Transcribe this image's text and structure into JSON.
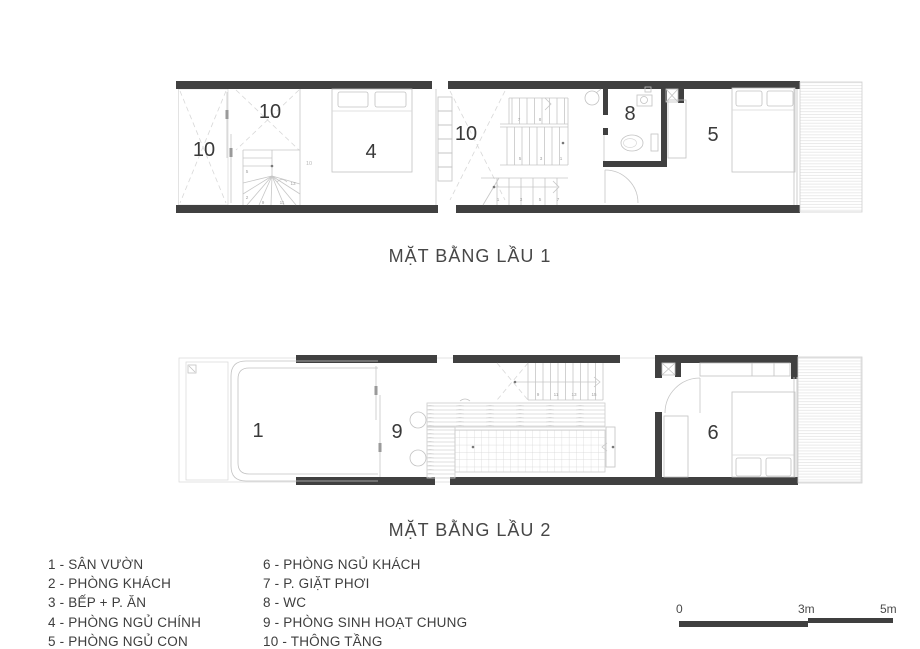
{
  "plan1": {
    "title": "MẶT BẰNG LẦU 1",
    "labels": {
      "void_left": "10",
      "void_mid": "10",
      "bed_main": "4",
      "void_stair": "10",
      "wc": "8",
      "bed_child": "5"
    },
    "stair": {
      "upper": [
        "7",
        "8"
      ],
      "mid": [
        "5",
        "3",
        "1"
      ],
      "lower": [
        "1",
        "3",
        "5",
        "7"
      ],
      "winder": [
        "5",
        "2",
        "9",
        "11",
        "13"
      ],
      "note": "10"
    }
  },
  "plan2": {
    "title": "MẶT BẰNG LẦU 2",
    "labels": {
      "garden": "1",
      "common": "9",
      "guest": "6"
    },
    "stair": {
      "treads": [
        "9",
        "11",
        "13",
        "15"
      ]
    }
  },
  "legend": {
    "left": [
      "1 - SÂN VƯỜN",
      "2 - PHÒNG KHÁCH",
      "3 - BẾP + P. ĂN",
      "4 - PHÒNG NGỦ CHÍNH",
      "5 - PHÒNG NGỦ CON"
    ],
    "right": [
      "6 - PHÒNG NGỦ KHÁCH",
      "7 - P. GIẶT PHƠI",
      "8 - WC",
      "9 - PHÒNG SINH HOẠT CHUNG",
      "10 - THÔNG TẦNG"
    ]
  },
  "scale": {
    "zero": "0",
    "three": "3m",
    "five": "5m"
  },
  "colors": {
    "wall": "#404040",
    "thin_line": "#c6c6c6",
    "text": "#3d3d3d"
  }
}
